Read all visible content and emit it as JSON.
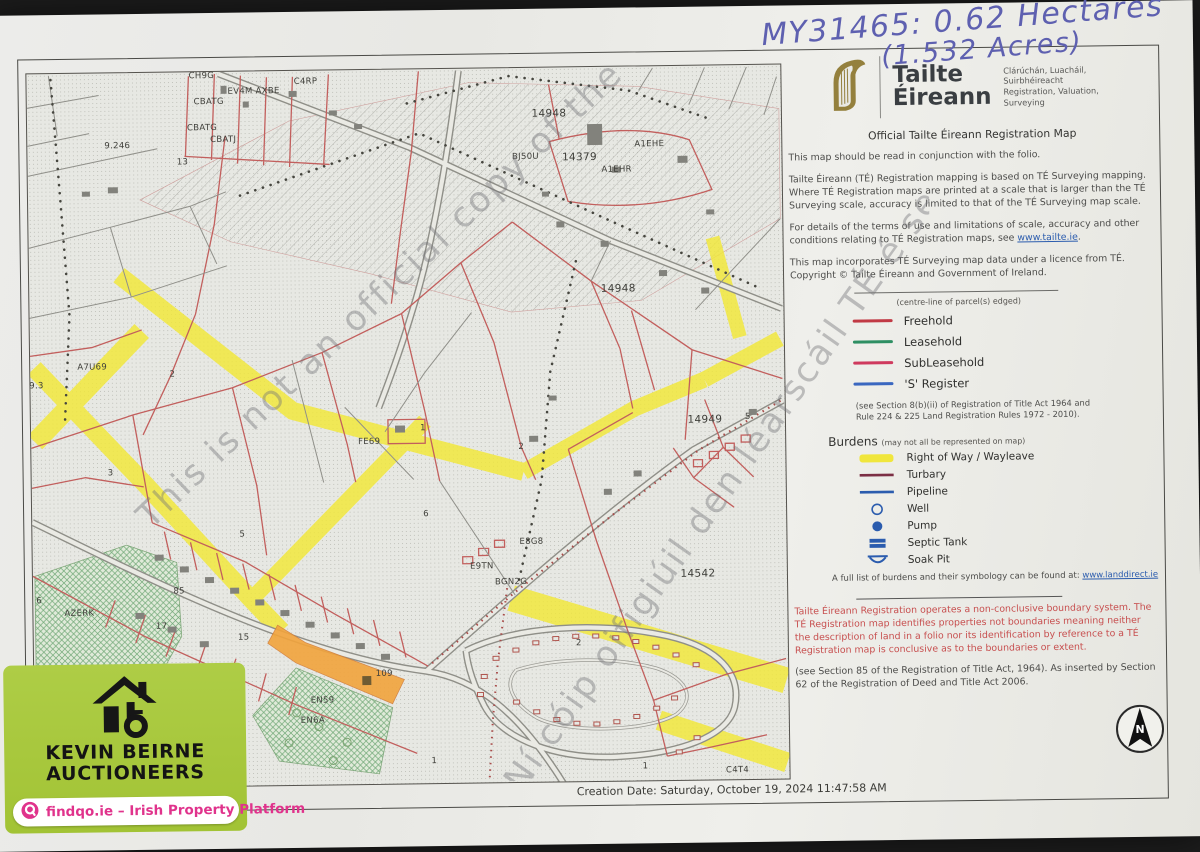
{
  "annotation": {
    "line1": "MY31465: 0.62 Hectares",
    "line2": "(1.532 Acres)",
    "ink_color": "#5e60b0"
  },
  "header": {
    "brand_line1": "Tailte",
    "brand_line2": "Éireann",
    "tagline_ga1": "Clárúchán, Luacháil,",
    "tagline_ga2": "Suirbhéireacht",
    "tagline_en1": "Registration, Valuation,",
    "tagline_en2": "Surveying",
    "doc_title": "Official Tailte Éireann Registration Map",
    "harp_color": "#94803d"
  },
  "paragraphs": {
    "p1": "This map should be read in conjunction with the folio.",
    "p2": "Tailte Éireann (TÉ) Registration mapping is based on TÉ Surveying mapping. Where TÉ Registration maps are printed at a scale that is larger than the TÉ Surveying scale, accuracy is limited to that of the TÉ Surveying map scale.",
    "p3_prefix": "For details of the terms of use and limitations of scale, accuracy and other conditions relating to TÉ Registration maps, see ",
    "p3_link": "www.tailte.ie",
    "p3_suffix": ".",
    "p4": "This map incorporates TÉ Surveying map data under a licence from TÉ. Copyright © Tailte Éireann and Government of Ireland."
  },
  "legend": {
    "note": "(centre-line of parcel(s) edged)",
    "items": [
      {
        "label": "Freehold",
        "color": "#c13a45"
      },
      {
        "label": "Leasehold",
        "color": "#2e8f63"
      },
      {
        "label": "SubLeasehold",
        "color": "#cf3a5e"
      },
      {
        "label": "'S' Register",
        "color": "#3a67c0"
      }
    ],
    "statute_note": "(see Section 8(b)(ii) of Registration of Title Act 1964 and Rule 224 & 225 Land Registration Rules 1972 - 2010)."
  },
  "burdens": {
    "title": "Burdens",
    "subtitle": "(may not all be represented on map)",
    "items": [
      {
        "label": "Right of Way / Wayleave",
        "symbol": "yellow-band",
        "color": "#f0e63c"
      },
      {
        "label": "Turbary",
        "symbol": "dark-red-line",
        "color": "#7c2f45"
      },
      {
        "label": "Pipeline",
        "symbol": "blue-line",
        "color": "#2b5cae"
      },
      {
        "label": "Well",
        "symbol": "open-circle",
        "color": "#2b5cae"
      },
      {
        "label": "Pump",
        "symbol": "filled-circle",
        "color": "#2b5cae"
      },
      {
        "label": "Septic Tank",
        "symbol": "filled-rect",
        "color": "#2b5cae"
      },
      {
        "label": "Soak Pit",
        "symbol": "open-bowl",
        "color": "#2b5cae"
      }
    ],
    "footer_prefix": "A full list of burdens and their symbology can be found at: ",
    "footer_link": "www.landdirect.ie"
  },
  "warning": {
    "text": "Tailte Éireann Registration operates a non-conclusive boundary system. The TÉ Registration map identifies properties not boundaries meaning neither the description of land in a folio nor its identification by reference to a TÉ Registration map is conclusive as to the boundaries or extent.",
    "color": "#c74f4f"
  },
  "statute2": "(see Section 85 of the Registration of Title Act, 1964). As inserted by Section 62 of the Registration of Deed and Title Act 2006.",
  "footer": {
    "creation_date": "Creation Date: Saturday, October 19, 2024 11:47:58 AM"
  },
  "compass": {
    "letter": "N"
  },
  "branding": {
    "agency_line1": "KEVIN BEIRNE",
    "agency_line2": "AUCTIONEERS",
    "platform": "findqo.ie – Irish Property Platform",
    "green": "#a8ca3f",
    "pink": "#e0338c"
  },
  "map": {
    "watermark1": "This is not an official copy of the TÉ map",
    "watermark2": "Ní cóip oifigiúil den léarscáil TÉ é seo",
    "right_of_way_color": "#f2e838",
    "parcel_line_color": "#c25f5d",
    "subject_parcel_color": "#f2a43c",
    "labels": [
      {
        "t": "CH9G",
        "x": 213,
        "y": 62
      },
      {
        "t": "EV4M AXBE",
        "x": 265,
        "y": 78
      },
      {
        "t": "C4RP",
        "x": 317,
        "y": 69
      },
      {
        "t": "CBATG",
        "x": 220,
        "y": 88
      },
      {
        "t": "CBATG",
        "x": 213,
        "y": 114
      },
      {
        "t": "CBATJ",
        "x": 234,
        "y": 126
      },
      {
        "t": "9.246",
        "x": 128,
        "y": 131
      },
      {
        "t": "13",
        "x": 193,
        "y": 148
      },
      {
        "t": "14948",
        "x": 560,
        "y": 104,
        "s": 10.5
      },
      {
        "t": "BJ50U",
        "x": 536,
        "y": 147
      },
      {
        "t": "14379",
        "x": 590,
        "y": 148,
        "s": 10.5
      },
      {
        "t": "A1EHE",
        "x": 660,
        "y": 136
      },
      {
        "t": "A1EHR",
        "x": 627,
        "y": 161
      },
      {
        "t": "14948",
        "x": 627,
        "y": 280,
        "s": 10.5
      },
      {
        "t": "A7U69",
        "x": 100,
        "y": 352
      },
      {
        "t": "9.3",
        "x": 44,
        "y": 370
      },
      {
        "t": "2",
        "x": 180,
        "y": 360
      },
      {
        "t": "3",
        "x": 117,
        "y": 458
      },
      {
        "t": "1",
        "x": 430,
        "y": 417
      },
      {
        "t": "2",
        "x": 528,
        "y": 437
      },
      {
        "t": "FE69",
        "x": 376,
        "y": 430
      },
      {
        "t": "6",
        "x": 432,
        "y": 503
      },
      {
        "t": "5",
        "x": 248,
        "y": 521
      },
      {
        "t": "14949",
        "x": 712,
        "y": 412,
        "s": 10.5
      },
      {
        "t": "5",
        "x": 755,
        "y": 410
      },
      {
        "t": "14542",
        "x": 703,
        "y": 566,
        "s": 10.5
      },
      {
        "t": "E8G8",
        "x": 537,
        "y": 532
      },
      {
        "t": "E9TN",
        "x": 487,
        "y": 556
      },
      {
        "t": "BGN2G",
        "x": 516,
        "y": 572
      },
      {
        "t": "2",
        "x": 583,
        "y": 634
      },
      {
        "t": "1",
        "x": 648,
        "y": 758
      },
      {
        "t": "C4T4",
        "x": 740,
        "y": 763
      },
      {
        "t": "AZERK",
        "x": 84,
        "y": 598
      },
      {
        "t": "85",
        "x": 184,
        "y": 577
      },
      {
        "t": "17",
        "x": 166,
        "y": 612
      },
      {
        "t": "15",
        "x": 248,
        "y": 624
      },
      {
        "t": "6",
        "x": 44,
        "y": 585
      },
      {
        "t": "EN59",
        "x": 326,
        "y": 688
      },
      {
        "t": "EN6A",
        "x": 316,
        "y": 708
      },
      {
        "t": "109",
        "x": 388,
        "y": 662
      },
      {
        "t": "1",
        "x": 437,
        "y": 750
      }
    ]
  }
}
